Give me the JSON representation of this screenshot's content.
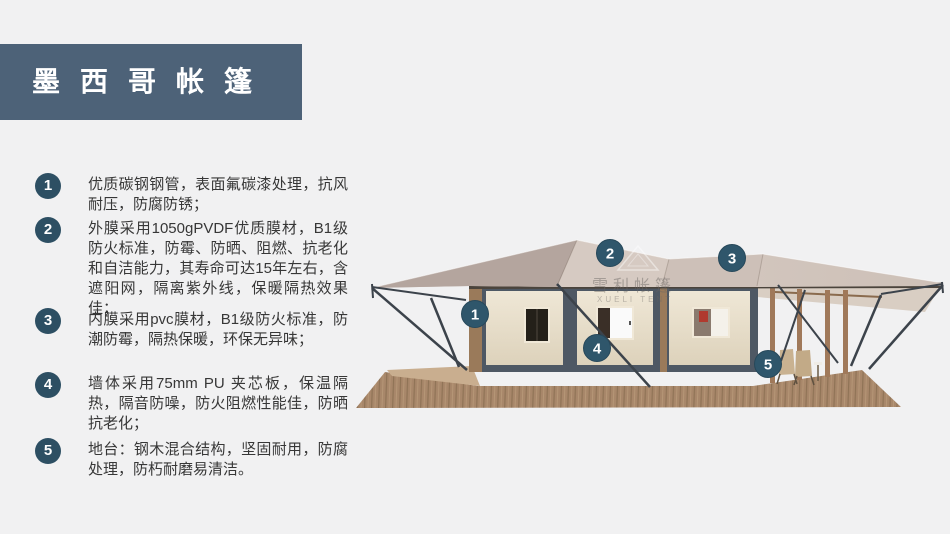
{
  "banner": {
    "title": "墨西哥帐篷"
  },
  "features": [
    {
      "num": "1",
      "text": "优质碳钢钢管，表面氟碳漆处理，抗风耐压，防腐防锈；"
    },
    {
      "num": "2",
      "text": "外膜采用1050gPVDF优质膜材，B1级防火标准，防霉、防晒、阻燃、抗老化和自洁能力，其寿命可达15年左右，含遮阳网，隔离紫外线，保暖隔热效果佳；"
    },
    {
      "num": "3",
      "text": "内膜采用pvc膜材，B1级防火标准，防潮防霉，隔热保暖，环保无异味；"
    },
    {
      "num": "4",
      "text": "墙体采用75mm PU 夹芯板，保温隔热，隔音防噪，防火阻燃性能佳，防晒抗老化；"
    },
    {
      "num": "5",
      "text": "地台：钢木混合结构，坚固耐用，防腐处理，防朽耐磨易清洁。"
    }
  ],
  "callouts": [
    "1",
    "2",
    "3",
    "4",
    "5"
  ],
  "watermark": {
    "cn": "雪利帐篷",
    "en": "XUELI TENT"
  },
  "colors": {
    "banner": "#4d6278",
    "badge": "#2d4f63",
    "callout": "#2f566b",
    "roof_light": "#d4c8c0",
    "roof_dark": "#b4a59e",
    "wall_cream": "#ece3d1",
    "frame_slate": "#4e5864",
    "deck_wood": "#a8876a",
    "background": "#f1f1f2"
  }
}
